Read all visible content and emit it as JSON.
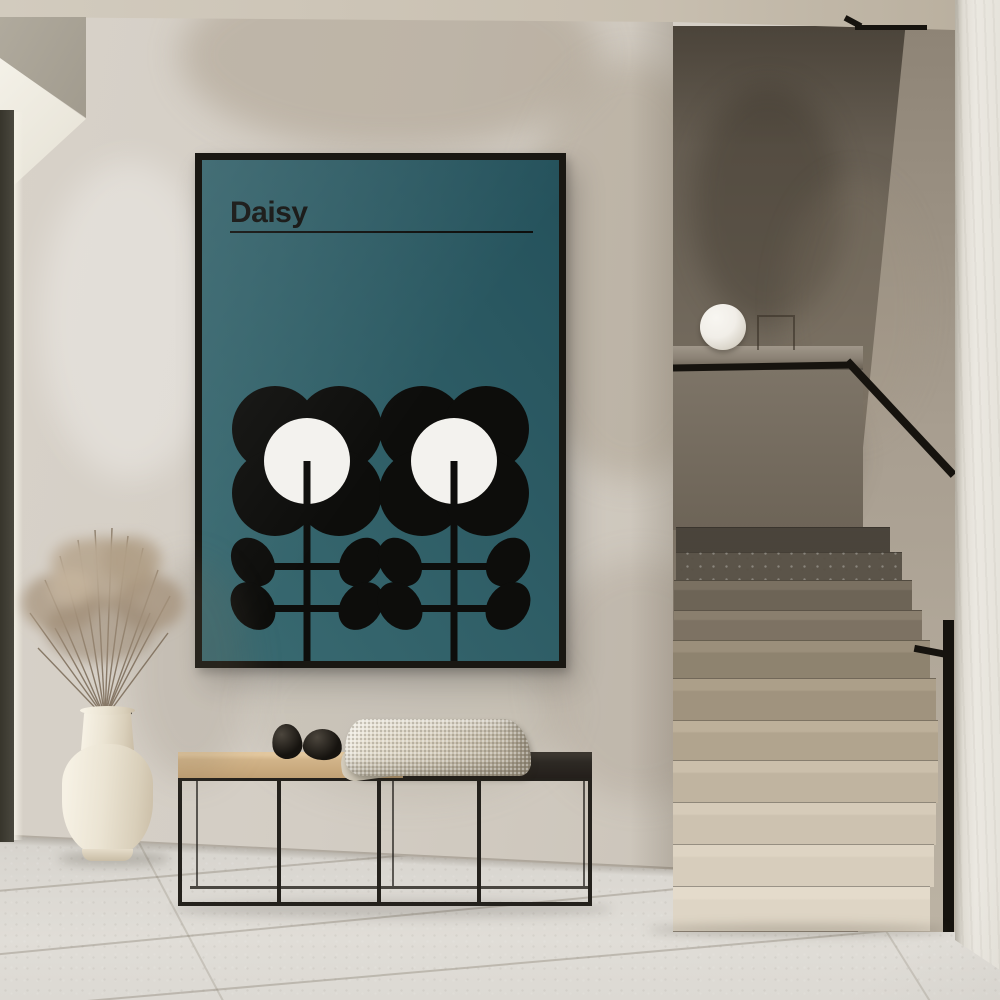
{
  "poster": {
    "title": "Daisy"
  },
  "colors": {
    "poster-teal-1": "#3a6b72",
    "poster-teal-2": "#24515b",
    "poster-ink": "#0d0d0b",
    "poster-white": "#f3f2ee",
    "frame-black": "#191712",
    "wall": "#d3cdc4",
    "ceiling": "#c9c1b2",
    "floor": "#dad7d1",
    "window-frame": "#37352c",
    "niche-wall": "#756c5f",
    "niche-right-wall": "#a89e90",
    "ledge": "#938a7d",
    "lamp": "#f1eee8",
    "rail": "#16130e",
    "step-light": "#ded5c5",
    "step-dark": "#4a443b",
    "bench-wood": "#d2b489",
    "bench-dark": "#2d2924",
    "bench-frame": "#24211c",
    "blanket": "#d3cbba",
    "pebble": "#16130f",
    "vase": "#ebe4d3",
    "grass": "#b3a08a",
    "right-wall": "#e9e6df"
  }
}
